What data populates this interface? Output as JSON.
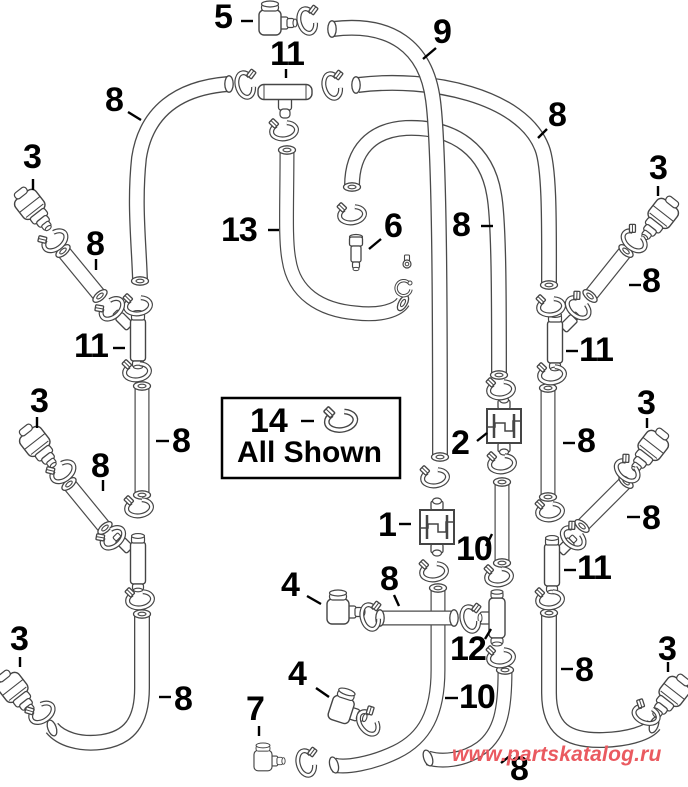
{
  "legend": {
    "number": "14",
    "caption": "All Shown"
  },
  "watermark": {
    "text": "www.partskatalog.ru",
    "color": "#ea5a60"
  },
  "callouts": [
    "5",
    "11",
    "9",
    "8",
    "8",
    "3",
    "3",
    "8",
    "13",
    "6",
    "8",
    "8",
    "11",
    "11",
    "3",
    "3",
    "8",
    "8",
    "2",
    "8",
    "1",
    "10",
    "8",
    "4",
    "8",
    "11",
    "12",
    "4",
    "10",
    "7",
    "8",
    "8",
    "3",
    "3",
    "8"
  ]
}
